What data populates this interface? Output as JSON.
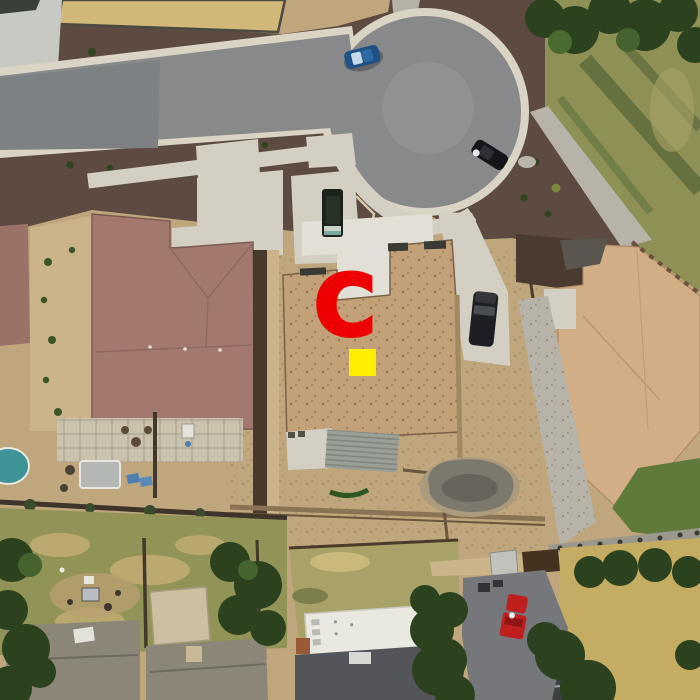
{
  "annotations": {
    "letter_marker": {
      "label": "C",
      "color": "#ee0000"
    },
    "target_square": {
      "color": "#fdee00"
    }
  },
  "palette": {
    "bare_dirt": "#bfa67c",
    "road_asphalt": "#87898b",
    "curb": "#d9d4c3",
    "concrete": "#d3cfc2",
    "mulch": "#5d4a40",
    "dry_field": "#d2b878",
    "dirt_light": "#cbb48a",
    "left_house_roof": "#a3796f",
    "construction_roof": "#c2a178",
    "right_house_roof": "#d2ae87",
    "gray_roof": "#8b8678",
    "dark_roof": "#54555a",
    "grass_olive": "#8e9055",
    "grass_green": "#5f7a3a",
    "grass_dry": "#c4ad62",
    "tree_dark": "#2c421f",
    "pool_water": "#3e9396",
    "gravel": "#b7b3a8",
    "wall_gray": "#9b988d",
    "trailer_white": "#e9e9e2",
    "vehicle_blue": "#1f5184",
    "vehicle_black": "#141419",
    "vehicle_red": "#bf1f1f",
    "van_dark": "#1c231b",
    "suv_dark": "#1e1e24"
  }
}
